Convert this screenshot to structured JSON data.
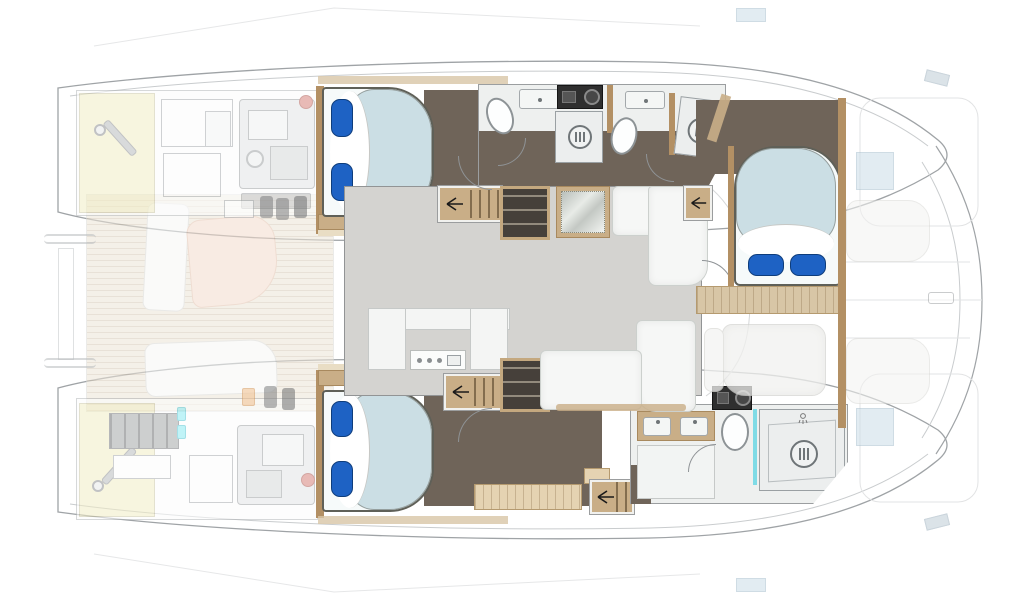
{
  "diagram": {
    "type": "yacht-floorplan",
    "vessel": "power-catamaran",
    "view": "top-down-deck-plan",
    "orientation": "bow-right",
    "background": "#ffffff",
    "colors": {
      "hull_line": "#9fa3a6",
      "deck_line": "#c9ccce",
      "faint_line": "#e2e3e4",
      "cabin_floor": "#6f6459",
      "salon_floor": "#d4d3d0",
      "cockpit_deck": "#ece4d7",
      "wood_trim": "#c9ae87",
      "wood_wall": "#b39064",
      "wood_cabinet": "#e5d3b2",
      "walkway_plank": "#d8c6a6",
      "bed_duvet": "#cbdee4",
      "bed_base": "#f6fafa",
      "pillow": "#1e62c4",
      "sofa_white": "#f6f7f6",
      "fixture_white": "#eef0ef",
      "shower_tray": "#eceeee",
      "shelf_dark": "#46403a",
      "appliance_dark": "#2f2f2f",
      "glass_teal": "#7fdbe6",
      "vent_cyan": "#8deaf2",
      "accent_red": "#d7837b",
      "accent_orange": "#f2c08e",
      "battery_gray": "#a6a8a9",
      "engine_gray": "#e3e5e6",
      "panel_cream": "#f2edc6",
      "hatch_blue": "#ccdde8",
      "sunpad": "#f3f3f1",
      "table_wood": "#f4dccd",
      "table_mirror_frame": "#c9ae87"
    },
    "rooms": {
      "port_hull_top": [
        "engine-room-aft",
        "guest-cabin-double-bed",
        "head-with-shower",
        "forward-shower-room"
      ],
      "starboard_hull_bottom": [
        "engine-room-aft",
        "guest-cabin-double-bed",
        "head-double-vanity",
        "large-shower-room"
      ],
      "main_deck": [
        "aft-cockpit-with-table",
        "salon-dinette",
        "galley-u-shaped",
        "forward-master-cabin",
        "bow-sunpad-deck"
      ]
    },
    "fixtures": {
      "double_beds": 3,
      "pillows_per_bed": 2,
      "toilets": 3,
      "shower_drains": 3,
      "sinks": 4,
      "washing_machines": 2,
      "stair_flights": 4,
      "engines": 2,
      "sunpads": 2,
      "deck_hatches": 2,
      "dining_tables": 2,
      "sofas": 2
    }
  }
}
